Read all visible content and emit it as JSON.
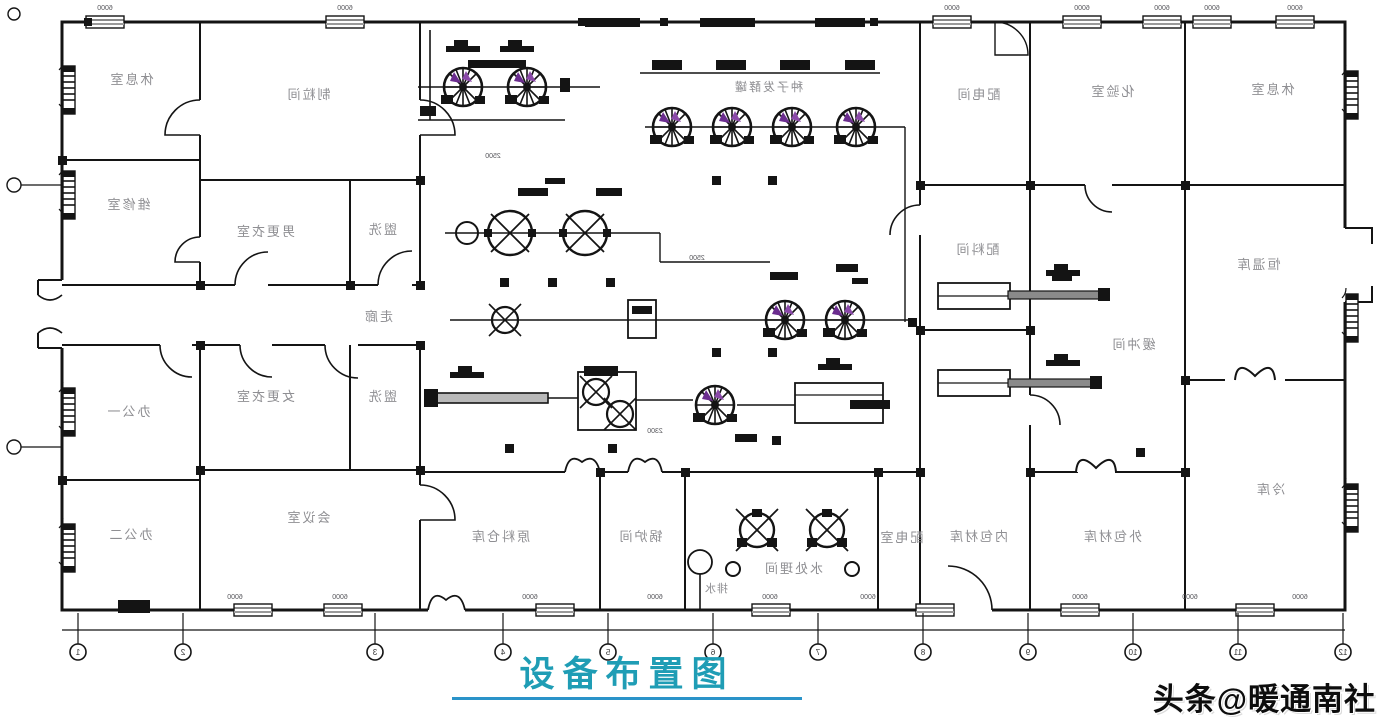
{
  "title": {
    "text": "设备布置图"
  },
  "watermark": {
    "text": "头条@暖通南社"
  },
  "colors": {
    "title_teal": "#1f9db5",
    "wall_black": "#141414",
    "label_gray": "#8f8f93",
    "accent_purple": "#6b2d8f",
    "pipe_gray": "#8a8a8a"
  },
  "rooms": [
    {
      "id": "rest-room-left",
      "label": "休息室"
    },
    {
      "id": "repair-room",
      "label": "维修室"
    },
    {
      "id": "office-1",
      "label": "办公一"
    },
    {
      "id": "office-2",
      "label": "办公二"
    },
    {
      "id": "granulation-room",
      "label": "制粒间"
    },
    {
      "id": "male-locker-room",
      "label": "男更衣室"
    },
    {
      "id": "washroom-1",
      "label": "盥洗"
    },
    {
      "id": "female-locker-room",
      "label": "女更衣室"
    },
    {
      "id": "washroom-2",
      "label": "盥洗"
    },
    {
      "id": "corridor",
      "label": "走廊"
    },
    {
      "id": "meeting-room",
      "label": "会议室"
    },
    {
      "id": "raw-material-warehouse",
      "label": "原料仓库"
    },
    {
      "id": "boiler-room",
      "label": "锅炉间"
    },
    {
      "id": "water-treatment-room",
      "label": "水处理间"
    },
    {
      "id": "power-dist-room",
      "label": "配电室"
    },
    {
      "id": "inner-pack-material-store",
      "label": "内包材库"
    },
    {
      "id": "outer-pack-material-store",
      "label": "外包材库"
    },
    {
      "id": "power-dist-bay",
      "label": "配电间"
    },
    {
      "id": "laboratory",
      "label": "化验室"
    },
    {
      "id": "rest-room-right",
      "label": "休息室"
    },
    {
      "id": "batching-room",
      "label": "配料间"
    },
    {
      "id": "const-temp-store",
      "label": "恒温库"
    },
    {
      "id": "buffer-room",
      "label": "缓冲间"
    },
    {
      "id": "cold-store",
      "label": "冷库"
    }
  ],
  "equipment": {
    "row_label": "种子发酵罐",
    "dim_small_1": "2500",
    "dim_small_2": "2500",
    "dim_small_3": "2300",
    "drain_label": "排水"
  },
  "axis": {
    "bay_dim": "6000",
    "bubbles": [
      "1",
      "2",
      "3",
      "4",
      "5",
      "6",
      "7",
      "8",
      "9",
      "10",
      "11",
      "12"
    ]
  }
}
